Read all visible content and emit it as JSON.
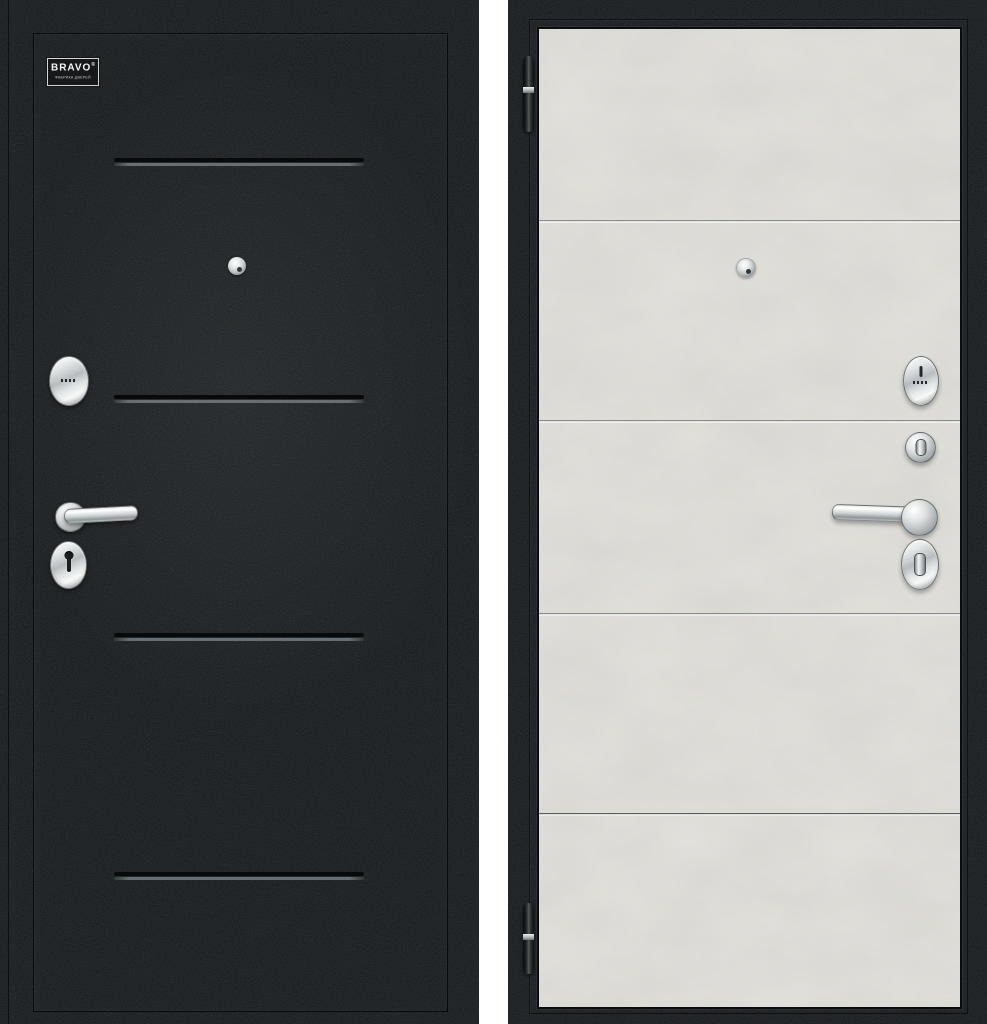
{
  "logo": {
    "brand": "BRAVO",
    "trademark": "®",
    "subtitle": "ФАБРИКА ДВЕРЕЙ"
  },
  "colors": {
    "background": "#ffffff",
    "door_black": "#141719",
    "panel_concrete": "#e5e4df",
    "chrome_hardware": "#ccd0d2",
    "groove_dark": "#08090b",
    "groove_highlight": "#686e71",
    "seam_line": "#8b8b88"
  },
  "left_door": {
    "view": "front",
    "groove_count": 4,
    "hardware": [
      "peephole",
      "cylinder-escutcheon",
      "lever-handle",
      "keyhole-escutcheon"
    ]
  },
  "right_door": {
    "view": "reverse",
    "seam_line_count": 4,
    "hinge_count": 2,
    "hardware": [
      "peephole",
      "keyway-escutcheon",
      "thumbturn",
      "lever-handle",
      "thumbturn-escutcheon"
    ]
  }
}
